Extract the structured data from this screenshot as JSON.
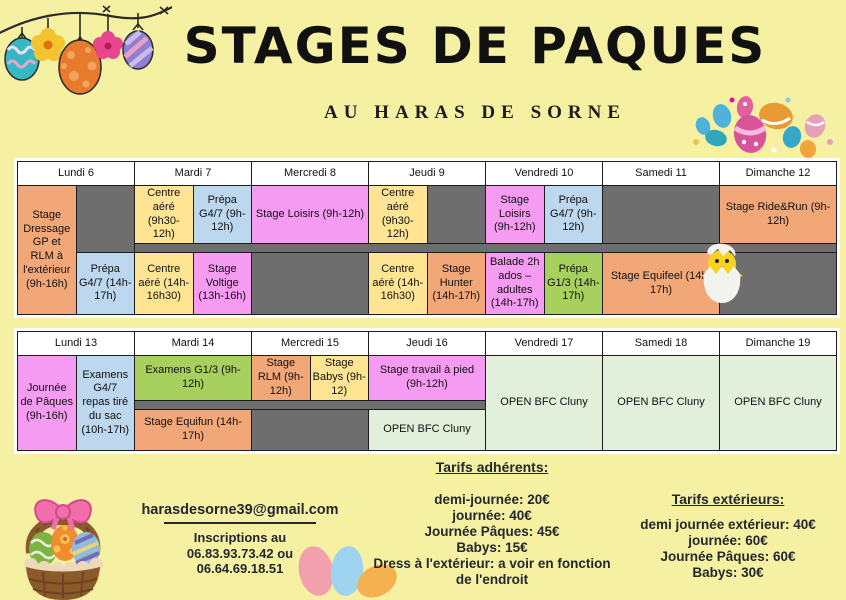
{
  "header": {
    "title": "STAGES DE PAQUES",
    "subtitle": "AU HARAS DE SORNE"
  },
  "week1": {
    "days": [
      "Lundi 6",
      "Mardi 7",
      "Mercredi 8",
      "Jeudi 9",
      "Vendredi 10",
      "Samedi 11",
      "Dimanche 12"
    ],
    "cells": {
      "dressage": "Stage Dressage GP et RLM à l'extérieur (9h-16h)",
      "prepa_g47_pm": "Prépa G4/7 (14h-17h)",
      "centre_aere_am": "Centre aéré (9h30-12h)",
      "prepa_g47_am": "Prépa G4/7 (9h-12h)",
      "centre_aere_pm": "Centre aéré (14h-16h30)",
      "voltige": "Stage Voltige (13h-16h)",
      "loisirs": "Stage Loisirs (9h-12h)",
      "hunter": "Stage Hunter (14h-17h)",
      "balade": "Balade 2h ados – adultes (14h-17h)",
      "prepa_g13": "Prépa G1/3 (14h-17h)",
      "equifeel": "Stage Equifeel (14h-17h)",
      "ride_run": "Stage Ride&Run (9h-12h)"
    }
  },
  "week2": {
    "days": [
      "Lundi 13",
      "Mardi 14",
      "Mercredi 15",
      "Jeudi 16",
      "Vendredi 17",
      "Samedi 18",
      "Dimanche 19"
    ],
    "cells": {
      "journee_paques": "Journée de Pâques (9h-16h)",
      "examens_g47": "Examens G4/7 repas tiré du sac (10h-17h)",
      "examens_g13": "Examens G1/3 (9h-12h)",
      "stage_rlm": "Stage RLM (9h-12h)",
      "stage_babys": "Stage Babys (9h-12)",
      "travail_pied": "Stage travail à pied (9h-12h)",
      "open_bfc": "OPEN BFC Cluny",
      "equifun": "Stage Equifun (14h-17h)"
    }
  },
  "contact": {
    "email": "harasdesorne39@gmail.com",
    "line1": "Inscriptions au",
    "line2": "06.83.93.73.42 ou",
    "line3": "06.64.69.18.51"
  },
  "tarifs_adherents": {
    "heading": "Tarifs adhérents:",
    "items": [
      "demi-journée: 20€",
      "journée: 40€",
      "Journée Pâques: 45€",
      "Babys: 15€",
      "Dress à l'extérieur: a voir en fonction de l'endroit"
    ]
  },
  "tarifs_exterieurs": {
    "heading": "Tarifs extérieurs:",
    "items": [
      "demi journée extérieur: 40€",
      "journée: 60€",
      "Journée Pâques: 60€",
      "Babys: 30€"
    ]
  },
  "decorations": {
    "garland": "hanging-eggs-garland",
    "cluster": "easter-eggs-cluster",
    "chick": "hatching-chick",
    "basket": "easter-basket-with-eggs",
    "trio": "three-pastel-eggs"
  },
  "colors": {
    "background": "#F6F1A2",
    "cell_orange": "#F2A778",
    "cell_yellow": "#FFE494",
    "cell_blue": "#BDD7EE",
    "cell_pink": "#F59BF2",
    "cell_green": "#A8D05F",
    "cell_open_green": "#E2EFDA",
    "cell_gray": "#6E6E6E",
    "text_dark": "#23272E"
  }
}
